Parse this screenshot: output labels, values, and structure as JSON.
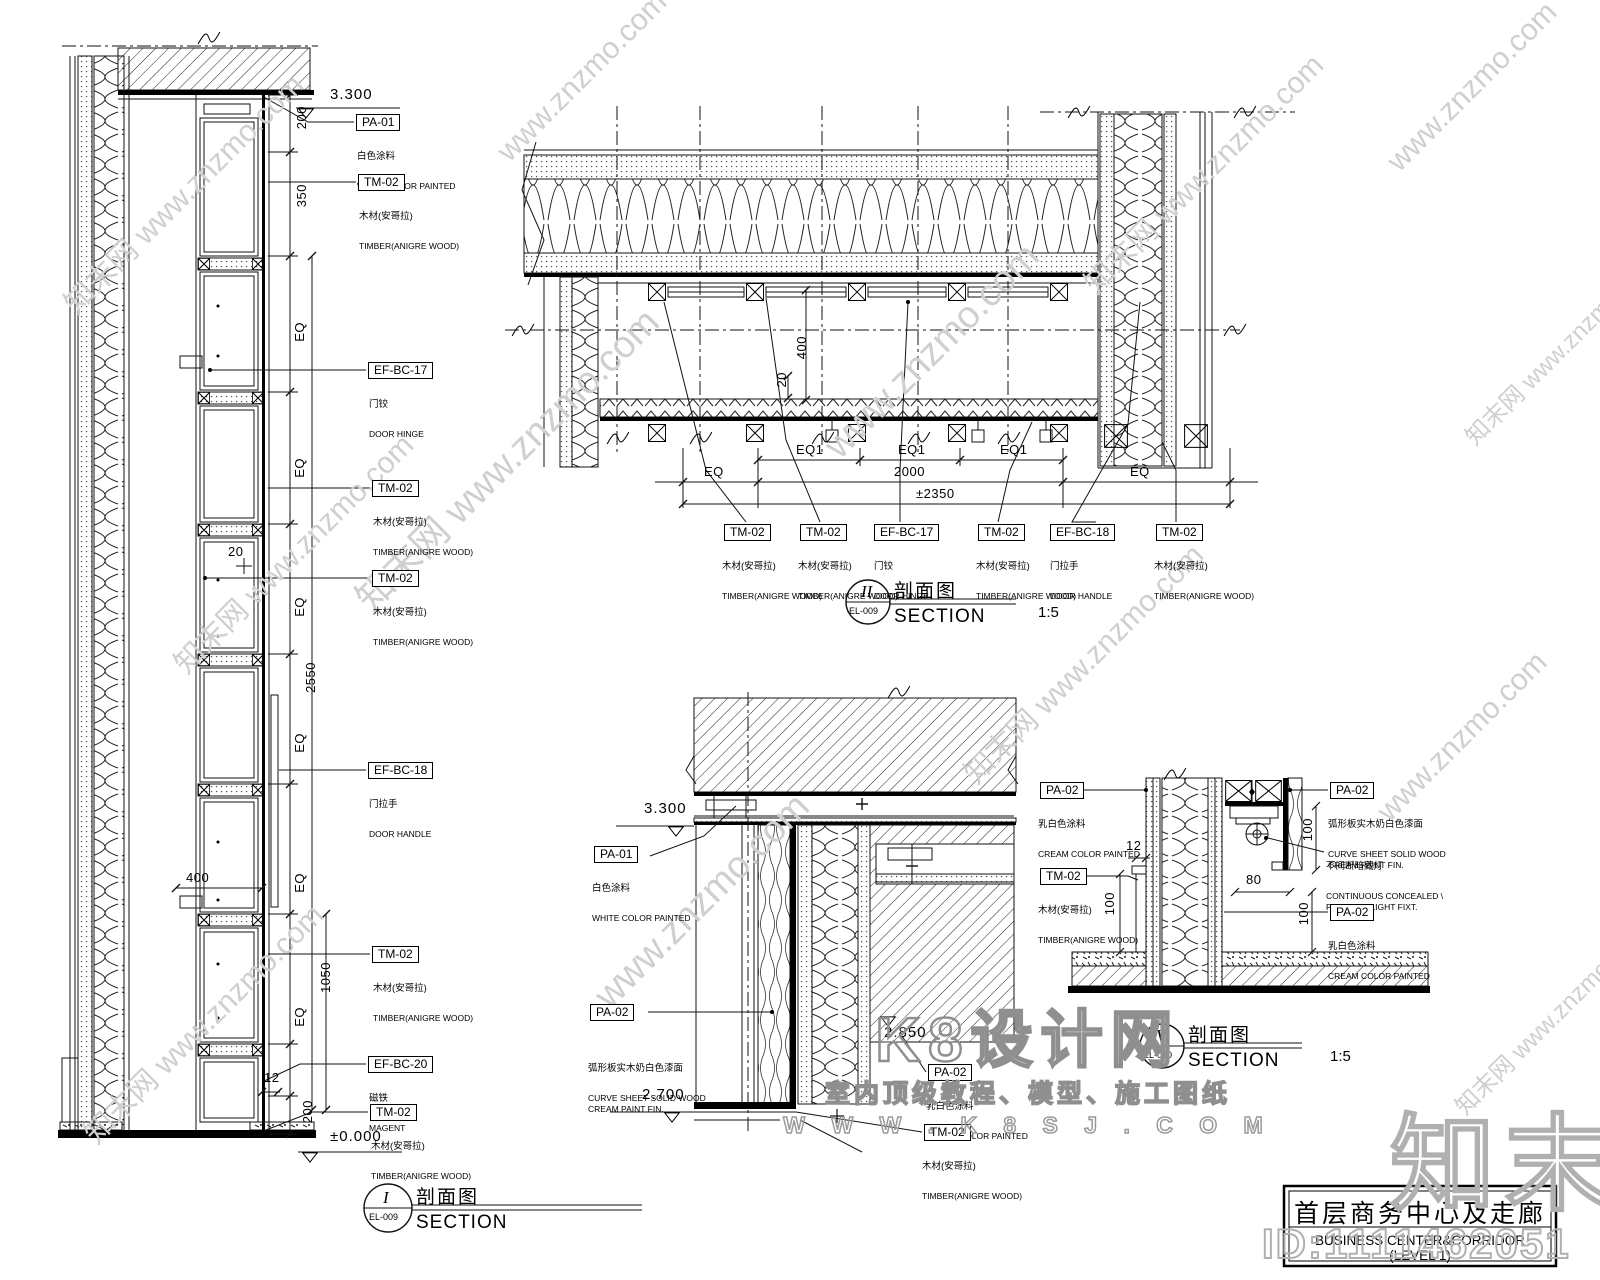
{
  "page": {
    "background": "#ffffff",
    "line_color": "#000000",
    "watermark_color": "#cfcfcf"
  },
  "watermarks": {
    "znzmo_full": "知末网 www.znzmo.com",
    "znzmo_url": "www.znzmo.com",
    "k8_title": "K8设计网",
    "k8_sub": "室内顶级教程、模型、施工图纸",
    "k8_url": "W W W . K 8 S J . C O M",
    "zhimo": "知末",
    "id_tag": "ID:1111462051"
  },
  "title_block": {
    "title_cn": "首层商务中心及走廊",
    "title_en": "BUSINESS CENTER&CORRIDOR (LEVEL 1)"
  },
  "sections": {
    "s1": {
      "num": "I",
      "sheet": "EL-009",
      "cn": "剖面图",
      "en": "SECTION",
      "scale": ""
    },
    "s2": {
      "num": "II",
      "sheet": "EL-009",
      "cn": "剖面图",
      "en": "SECTION",
      "scale": "1:5"
    },
    "s5": {
      "num": "V",
      "sheet": "EL-010",
      "cn": "剖面图",
      "en": "SECTION",
      "scale": "1:5"
    }
  },
  "detail_left": {
    "level_top": "3.300",
    "level_bottom": "±0.000",
    "d200_top": "200",
    "d350": "350",
    "eq": "EQ",
    "d2550": "2550",
    "d20": "20",
    "d400": "400",
    "d1050": "1050",
    "d12": "12",
    "d200_bottom": "200",
    "labels": [
      {
        "code": "PA-01",
        "zh": "白色涂料",
        "en": "WHITE COLOR PAINTED"
      },
      {
        "code": "TM-02",
        "zh": "木材(安哥拉)",
        "en": "TIMBER(ANIGRE WOOD)"
      },
      {
        "code": "EF-BC-17",
        "zh": "门铰",
        "en": "DOOR HINGE"
      },
      {
        "code": "TM-02",
        "zh": "木材(安哥拉)",
        "en": "TIMBER(ANIGRE WOOD)"
      },
      {
        "code": "TM-02",
        "zh": "木材(安哥拉)",
        "en": "TIMBER(ANIGRE WOOD)"
      },
      {
        "code": "EF-BC-18",
        "zh": "门拉手",
        "en": "DOOR HANDLE"
      },
      {
        "code": "TM-02",
        "zh": "木材(安哥拉)",
        "en": "TIMBER(ANIGRE WOOD)"
      },
      {
        "code": "EF-BC-20",
        "zh": "磁铁",
        "en": "MAGENT"
      },
      {
        "code": "TM-02",
        "zh": "木材(安哥拉)",
        "en": "TIMBER(ANIGRE WOOD)"
      }
    ]
  },
  "detail_plan": {
    "eq": "EQ",
    "eq1": "EQ1",
    "d2000": "2000",
    "d2350": "±2350",
    "d400": "400",
    "d20": "20",
    "labels": [
      {
        "code": "TM-02",
        "zh": "木材(安哥拉)",
        "en": "TIMBER(ANIGRE WOOD)"
      },
      {
        "code": "TM-02",
        "zh": "木材(安哥拉)",
        "en": "TIMBER(ANIGRE WOOD)"
      },
      {
        "code": "EF-BC-17",
        "zh": "门铰",
        "en": "DOOR HINGE"
      },
      {
        "code": "TM-02",
        "zh": "木材(安哥拉)",
        "en": "TIMBER(ANIGRE WOOD)"
      },
      {
        "code": "EF-BC-18",
        "zh": "门拉手",
        "en": "DOOR HANDLE"
      },
      {
        "code": "TM-02",
        "zh": "木材(安哥拉)",
        "en": "TIMBER(ANIGRE WOOD)"
      }
    ]
  },
  "detail_mid": {
    "level_top": "3.300",
    "level_mid": "2.850",
    "level_bottom": "2.700",
    "labels": [
      {
        "code": "PA-01",
        "zh": "白色涂料",
        "en": "WHITE COLOR PAINTED"
      },
      {
        "code": "PA-02",
        "zh": "弧形板实木奶白色漆面",
        "en": "CURVE SHEET  SOLID WOOD\nCREAM PAINT FIN."
      },
      {
        "code": "PA-02",
        "zh": "乳白色涂料",
        "en": "CREAM COLOR PAINTED"
      },
      {
        "code": "TM-02",
        "zh": "木材(安哥拉)",
        "en": "TIMBER(ANIGRE WOOD)"
      }
    ]
  },
  "detail_right": {
    "d12": "12",
    "d100_a": "100",
    "d100_b": "100",
    "d100_c": "100",
    "d80": "80",
    "labels": [
      {
        "code": "PA-02",
        "zh": "乳白色涂料",
        "en": "CREAM COLOR PAINTED"
      },
      {
        "code": "TM-02",
        "zh": "木材(安哥拉)",
        "en": "TIMBER(ANIGRE WOOD)"
      },
      {
        "code": "PA-02",
        "zh": "弧形板实木奶白色漆面",
        "en": "CURVE SHEET  SOLID WOOD\nCREAM PAINT FIN."
      },
      {
        "code": "",
        "zh": "不间断暗藏灯",
        "en": "CONTINUOUS CONCEALED \\\nPLUCIFER LIGHT FIXT."
      },
      {
        "code": "PA-02",
        "zh": "乳白色涂料",
        "en": "CREAM COLOR PAINTED"
      }
    ]
  }
}
